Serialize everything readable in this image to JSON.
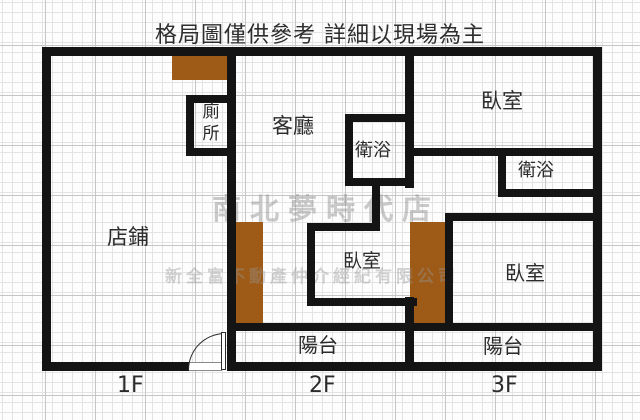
{
  "title": "格局圖僅供參考 詳細以現場為主",
  "watermarks": {
    "store": "南北夢時代店",
    "company": "新全富不動產仲介經紀有限公司"
  },
  "floors": {
    "f1": "1F",
    "f2": "2F",
    "f3": "3F"
  },
  "rooms": {
    "shop": "店鋪",
    "toilet": "廁所",
    "living": "客廳",
    "bath_2f": "衛浴",
    "bed_2f": "臥室",
    "balcony_2f": "陽台",
    "bed_3f_upper": "臥室",
    "bath_3f": "衛浴",
    "bed_3f_lower": "臥室",
    "balcony_3f": "陽台"
  },
  "colors": {
    "wall": "#141414",
    "stairs": "#9d5b17",
    "grid_minor": "#e3e3e3",
    "grid_major": "#c6c6c6",
    "watermark": "#969696"
  }
}
